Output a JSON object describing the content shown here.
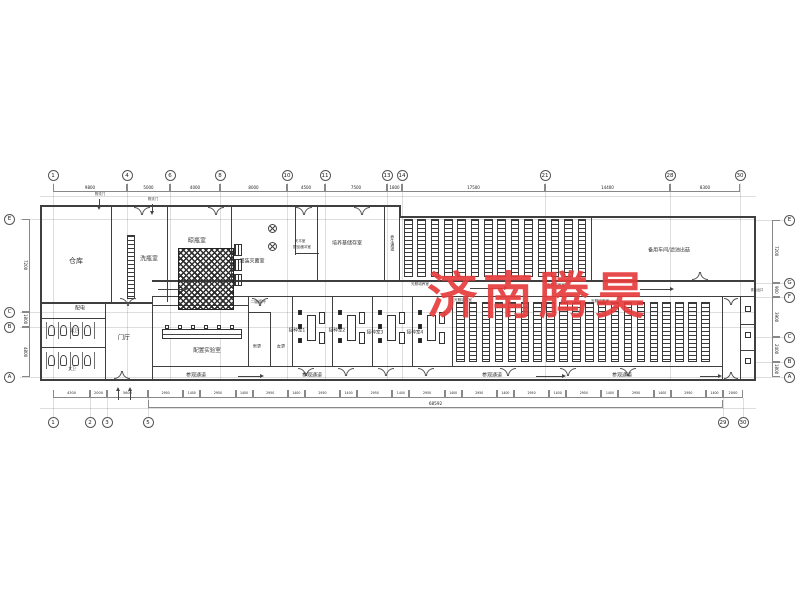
{
  "watermark": {
    "text": "济南腾昊",
    "color": "#e73c3c"
  },
  "axes": {
    "top": [
      [
        "1",
        53
      ],
      [
        "4",
        127
      ],
      [
        "6",
        170
      ],
      [
        "8",
        220
      ],
      [
        "10",
        287
      ],
      [
        "11",
        325
      ],
      [
        "13",
        387
      ],
      [
        "14",
        402
      ],
      [
        "21",
        545
      ],
      [
        "28",
        670
      ],
      [
        "30",
        740
      ]
    ],
    "bottom": [
      [
        "1",
        53
      ],
      [
        "2",
        90
      ],
      [
        "3",
        107
      ],
      [
        "5",
        148
      ],
      [
        "29",
        723
      ],
      [
        "30",
        743
      ]
    ],
    "left": [
      [
        "E",
        219
      ],
      [
        "C",
        312
      ],
      [
        "B",
        327
      ],
      [
        "A",
        377
      ]
    ],
    "right": [
      [
        "E",
        220
      ],
      [
        "G",
        283
      ],
      [
        "F",
        297
      ],
      [
        "C",
        337
      ],
      [
        "B",
        362
      ],
      [
        "A",
        377
      ]
    ]
  },
  "dimensions": {
    "top": [
      [
        "9800",
        53,
        127
      ],
      [
        "5000",
        127,
        170
      ],
      [
        "4000",
        170,
        220
      ],
      [
        "8000",
        220,
        287
      ],
      [
        "4500",
        287,
        325
      ],
      [
        "7500",
        325,
        387
      ],
      [
        "1800",
        387,
        402
      ],
      [
        "17500",
        402,
        545
      ],
      [
        "14400",
        545,
        670
      ],
      [
        "8300",
        670,
        740
      ]
    ],
    "bottom_left": [
      [
        "4300",
        53,
        90
      ],
      [
        "2000",
        90,
        107
      ],
      [
        "5600",
        107,
        148
      ]
    ],
    "bottom_pattern": {
      "labels": [
        "2950",
        "1400"
      ],
      "from": 148,
      "to": 723,
      "pairs": 11
    },
    "bottom_right": [
      [
        "2000",
        723,
        743
      ]
    ],
    "bottom_total": "68592",
    "left": [
      [
        "7200",
        219,
        312
      ],
      [
        "1800",
        312,
        327
      ],
      [
        "4800",
        327,
        377
      ]
    ],
    "right": [
      [
        "7200",
        220,
        283
      ],
      [
        "900",
        283,
        297
      ],
      [
        "3900",
        297,
        337
      ],
      [
        "2400",
        337,
        362
      ],
      [
        "1800",
        362,
        377
      ]
    ]
  },
  "rooms": [
    [
      "仓库",
      76,
      262,
      7,
      0
    ],
    [
      "洗瓶室",
      149,
      260,
      6,
      0
    ],
    [
      "晾瓶室",
      197,
      242,
      6,
      0
    ],
    [
      "灌装灭菌室",
      252,
      262,
      5,
      0
    ],
    [
      "天平室",
      300,
      242,
      3.6,
      0
    ],
    [
      "配品缓冲室",
      302,
      248,
      3.6,
      0
    ],
    [
      "培养基储存室",
      347,
      244,
      5,
      0
    ],
    [
      "养生通道",
      392,
      243,
      4,
      1
    ],
    [
      "备用车间/滤油出菇",
      669,
      251,
      5,
      0
    ],
    [
      "光照培养室",
      420,
      285,
      3.6,
      0
    ],
    [
      "光照培养室",
      556,
      286,
      3.6,
      0
    ],
    [
      "光照培养室",
      463,
      301,
      3.6,
      0
    ],
    [
      "光照培养室",
      600,
      302,
      3.6,
      0
    ],
    [
      "配电",
      80,
      309,
      5,
      0
    ],
    [
      "男卫",
      74,
      331,
      3.8,
      0
    ],
    [
      "女卫",
      72,
      369,
      3.8,
      0
    ],
    [
      "门厅",
      124,
      339,
      6,
      0
    ],
    [
      "配置实验室",
      207,
      351,
      5.5,
      0
    ],
    [
      "二级缓冲",
      258,
      302,
      3.8,
      0
    ],
    [
      "男更",
      257,
      347,
      4.2,
      0
    ],
    [
      "女更",
      281,
      347,
      4.2,
      0
    ],
    [
      "接种室1",
      297,
      331,
      4.6,
      0
    ],
    [
      "接种室2",
      337,
      331,
      4.6,
      0
    ],
    [
      "接种室3",
      375,
      333,
      4.6,
      0
    ],
    [
      "接种室4",
      415,
      333,
      4.6,
      0
    ],
    [
      "参观通道",
      196,
      376,
      5,
      0
    ],
    [
      "参观通道",
      312,
      376,
      5,
      0
    ],
    [
      "参观通道",
      492,
      376,
      5,
      0
    ],
    [
      "参观通道",
      622,
      376,
      5,
      0
    ],
    [
      "物流门",
      100,
      195,
      3.4,
      0
    ],
    [
      "物流门",
      153,
      200,
      3.4,
      0
    ],
    [
      "紧急出口",
      757,
      291,
      3.2,
      0
    ]
  ]
}
